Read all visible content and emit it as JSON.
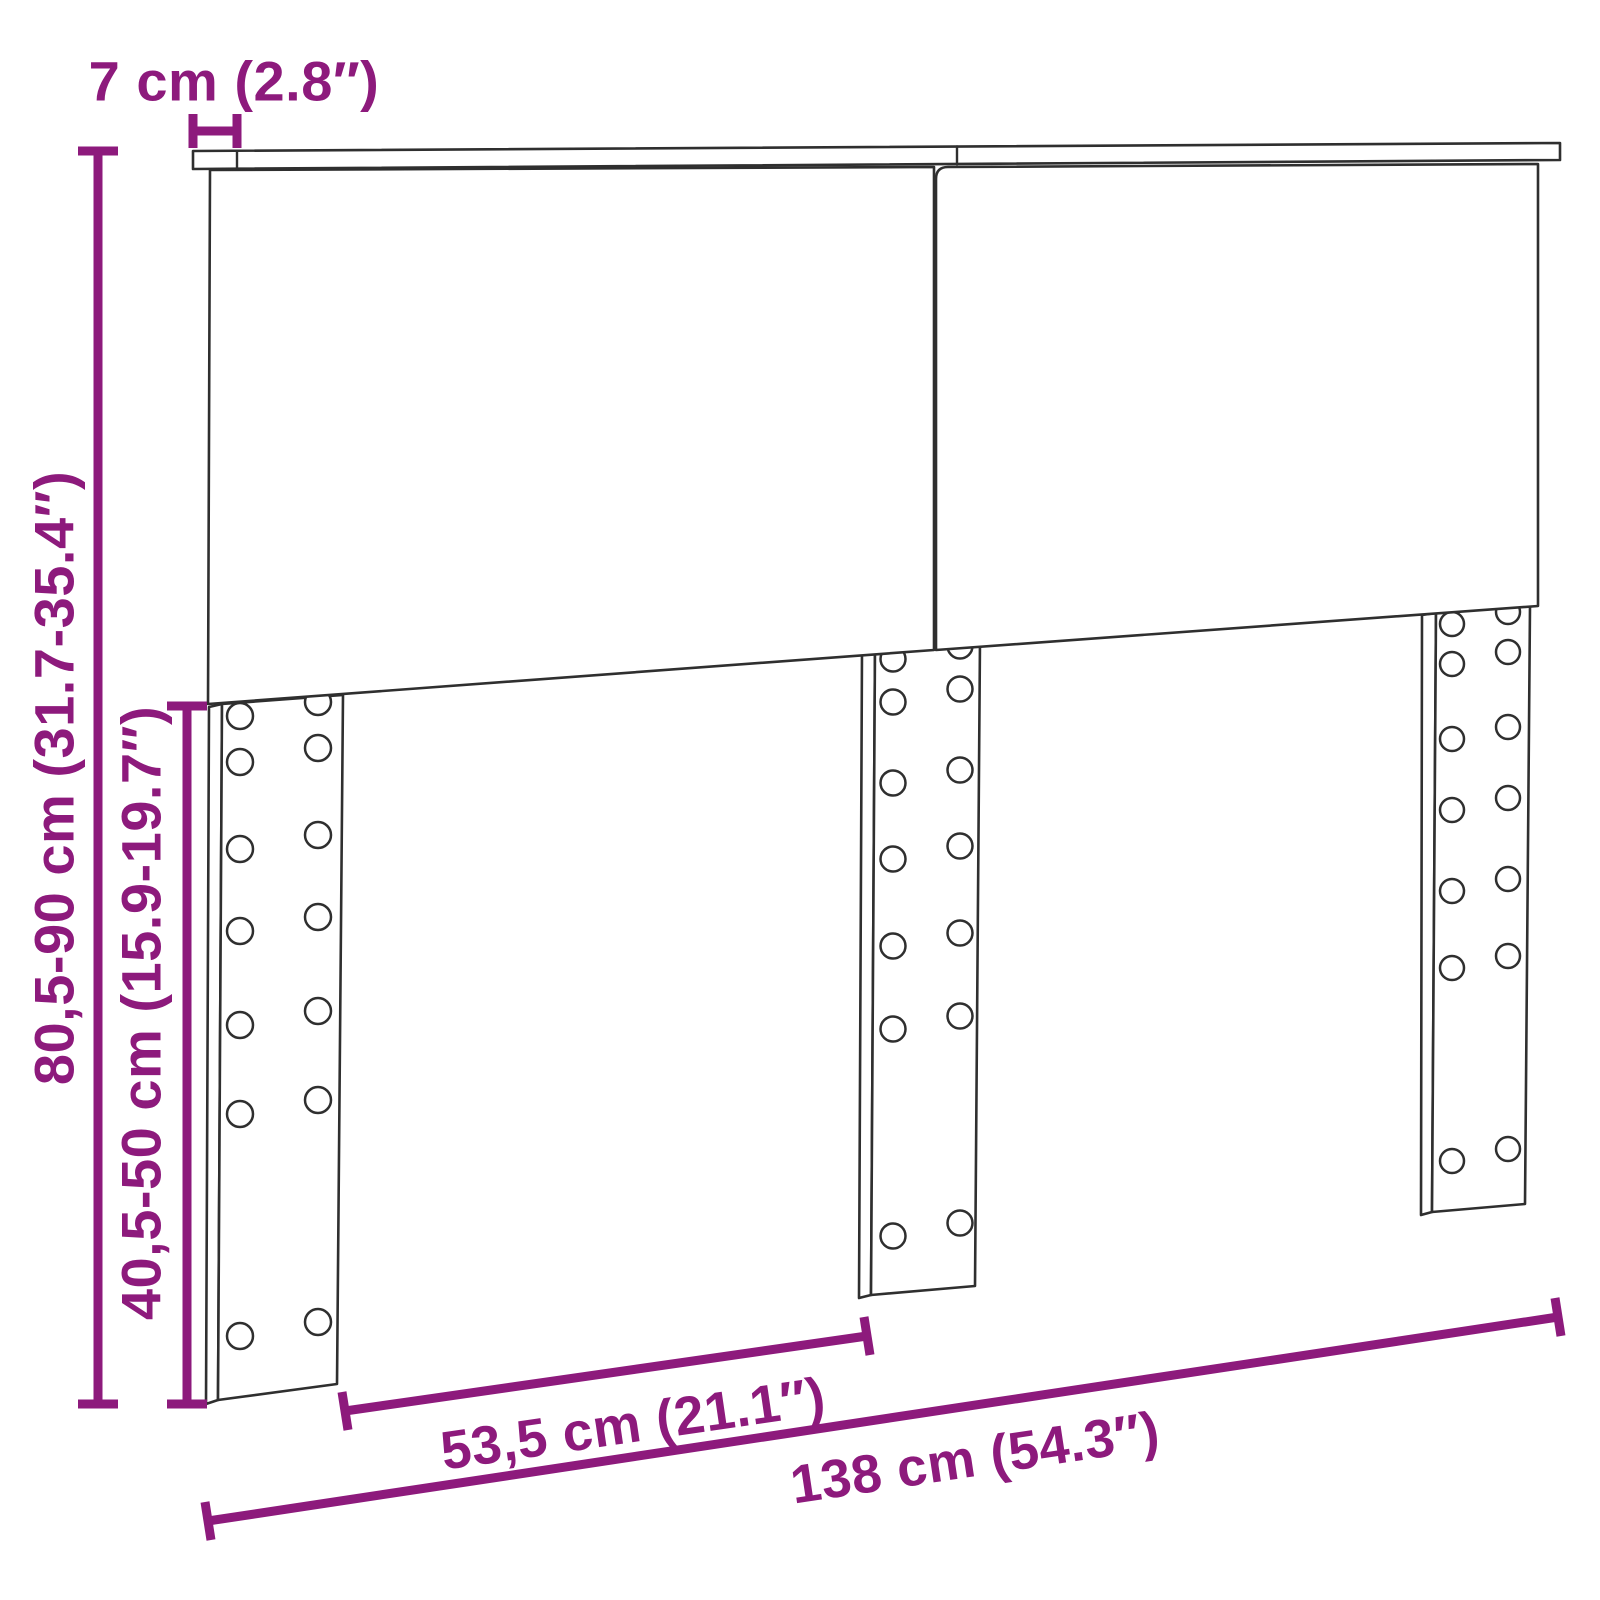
{
  "diagram": {
    "type": "furniture-dimension-drawing",
    "subject": "headboard with three pre-drilled mounting strips",
    "background": "#ffffff",
    "line_color": "#2f2f2f",
    "dimension_color": "#8d1a7c",
    "dimensions": {
      "board_depth": {
        "label": "7 cm (2.8″)"
      },
      "total_height": {
        "label": "80,5-90 cm (31.7-35.4″)"
      },
      "strip_height": {
        "label": "40,5-50 cm (15.9-19.7″)"
      },
      "strip_offset": {
        "label": "53,5 cm (21.1″)"
      },
      "total_width": {
        "label": "138 cm (54.3″)"
      }
    }
  }
}
